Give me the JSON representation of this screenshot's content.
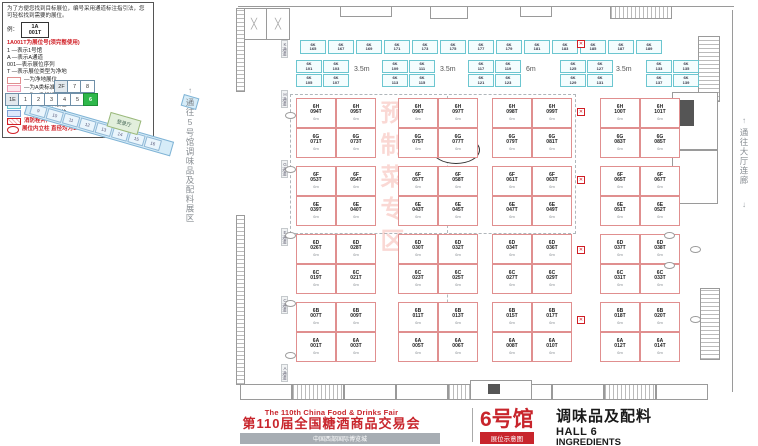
{
  "legend": {
    "intro": "为了方便您找到目标展位，编号采用通道标注指引法，您可轻松找到需要的展位。",
    "example_caption": "例：",
    "example_top": "1A",
    "example_bottom": "001T",
    "note_red": "1A001T为展位号(须完整使用)",
    "decode_lines": [
      "1 —表示1号馆",
      "A —表示A通道",
      "001—表示展位序列",
      "T —表示展位类型为净地"
    ],
    "types": [
      {
        "label": "—为净地展位",
        "color": "#ffffff",
        "border": "#e08f8f"
      },
      {
        "label": "—为A类标准展位",
        "color": "#fde9ef",
        "border": "#ef9db5"
      },
      {
        "label": "—为B类标准展位",
        "color": "#fdfbd6",
        "border": "#d8cf6a"
      },
      {
        "label": "—为C类标准展位",
        "color": "#e3f7fa",
        "border": "#6cc6d0"
      },
      {
        "label": "—为D类标准展位",
        "color": "#dde9fb",
        "border": "#7e9fd4"
      }
    ],
    "fire_note": "消防栓井严禁遮挡",
    "pillar_note": "展位内立柱 直径均为1.5m"
  },
  "minimap": {
    "upper_row": [
      "2F",
      "7",
      "8"
    ],
    "lower_row": [
      "1E",
      "1",
      "2",
      "3",
      "4",
      "5",
      "6"
    ],
    "highlight": "6",
    "diagonal": [
      "9",
      "10",
      "11",
      "12",
      "13",
      "14",
      "15",
      "16"
    ],
    "arrow": "↗",
    "green_box": "登录厅"
  },
  "corridors": {
    "left": "通往5号馆调味品及配料展区",
    "right": "通往大厅连廊",
    "arrow_up": "↑",
    "arrow_down": "↓"
  },
  "plan": {
    "hall_circle": "6",
    "watermark": "预制菜专区",
    "aisles": [
      "K通道",
      "H通道",
      "G通道",
      "E通道",
      "C通道",
      "A通道"
    ],
    "dims": [
      "3.5m",
      "3.5m",
      "6m",
      "3.5m"
    ],
    "booth_sub": "6m",
    "strip_prefix": "6K",
    "strip_nums": [
      "165",
      "167",
      "169",
      "171",
      "173",
      "175",
      "177",
      "179",
      "181",
      "183",
      "185",
      "187",
      "189"
    ],
    "band_prefix": "6K",
    "band_groups": [
      [
        "101",
        "103",
        "105",
        "107"
      ],
      [
        "109",
        "111",
        "113",
        "115"
      ],
      [
        "117",
        "119",
        "121",
        "123"
      ],
      [
        "125",
        "127",
        "129",
        "131"
      ],
      [
        "133",
        "135",
        "137",
        "139"
      ]
    ],
    "blocks": [
      {
        "rows": [
          {
            "prefix": "6H",
            "nums": [
              "094T",
              "095T",
              "096T",
              "097T",
              "098T",
              "099T",
              "100T",
              "101T"
            ]
          },
          {
            "prefix": "6G",
            "nums": [
              "071T",
              "073T",
              "075T",
              "077T",
              "079T",
              "081T",
              "083T",
              "085T"
            ]
          }
        ]
      },
      {
        "rows": [
          {
            "prefix": "6F",
            "nums": [
              "053T",
              "054T",
              "057T",
              "058T",
              "061T",
              "063T",
              "065T",
              "067T"
            ]
          },
          {
            "prefix": "6E",
            "nums": [
              "039T",
              "040T",
              "043T",
              "045T",
              "047T",
              "049T",
              "051T",
              "052T"
            ]
          }
        ]
      },
      {
        "rows": [
          {
            "prefix": "6D",
            "nums": [
              "026T",
              "028T",
              "030T",
              "032T",
              "034T",
              "036T",
              "037T",
              "038T"
            ]
          },
          {
            "prefix": "6C",
            "nums": [
              "019T",
              "021T",
              "023T",
              "025T",
              "027T",
              "029T",
              "031T",
              "033T"
            ]
          }
        ]
      },
      {
        "rows": [
          {
            "prefix": "6B",
            "nums": [
              "007T",
              "009T",
              "011T",
              "013T",
              "015T",
              "017T",
              "018T",
              "020T"
            ]
          },
          {
            "prefix": "6A",
            "nums": [
              "001T",
              "003T",
              "005T",
              "006T",
              "008T",
              "010T",
              "012T",
              "014T"
            ]
          }
        ]
      }
    ]
  },
  "footer": {
    "en_title": "The 110th China Food & Drinks Fair",
    "cn_title": "第110届全国糖酒商品交易会",
    "venue": "中国西部国际博览城",
    "hall_big": "6号馆",
    "badge": "展位示意图",
    "cat_cn": "调味品及配料",
    "hall_en": "HALL 6",
    "cat_en": "INGREDIENTS"
  }
}
